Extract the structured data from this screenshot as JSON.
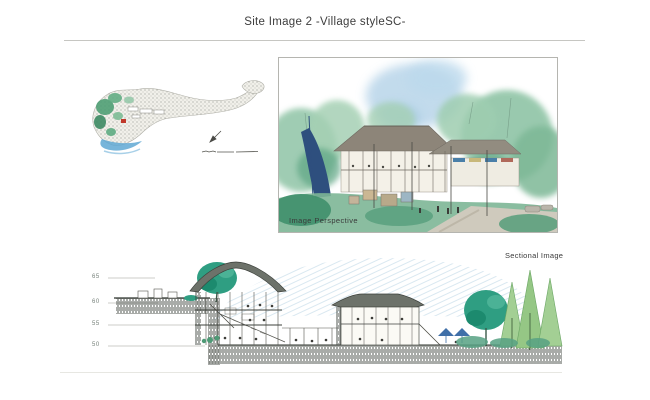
{
  "page": {
    "title": "Site Image 2  -Village styleSC-"
  },
  "figures": {
    "site_plan": {
      "description": "watercolor master site plan",
      "icons": [
        "north-arrow",
        "scale-bar"
      ]
    },
    "perspective": {
      "label": "Image Perspective"
    },
    "sectional": {
      "label": "Sectional Image",
      "elevation_labels": [
        "65",
        "60",
        "55",
        "50"
      ]
    }
  },
  "colors": {
    "text_dark": "#3d3d3d",
    "rule_gray": "#c6c6c2",
    "watercolor_green": "#7db896",
    "deep_green": "#3f8f6b",
    "teal_green": "#2f9e82",
    "pine_green": "#a3cf94",
    "sky_blue": "#aecfe6",
    "water_blue": "#5fa8d4",
    "slide_navy": "#2e4f7e",
    "roof_gray": "#8d8579",
    "earth_dark": "#3e443d",
    "marker_red": "#c0392b"
  }
}
